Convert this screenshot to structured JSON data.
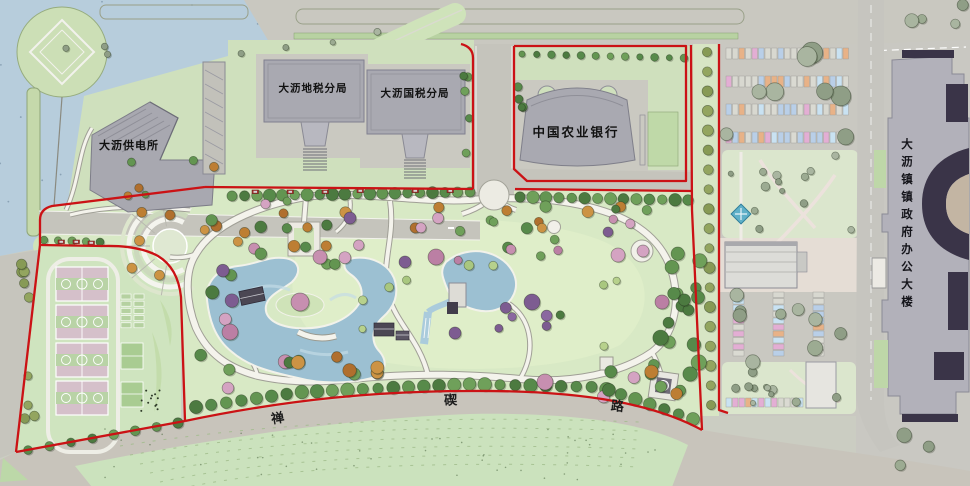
{
  "plan": {
    "title": "大沥镇政府周边公园景观总平面图",
    "buildings": {
      "power_station": "大沥供电所",
      "local_tax": "大沥地税分局",
      "national_tax": "大沥国税分局",
      "bank": "中国农业银行",
      "government": "大沥镇镇政府办公大楼"
    },
    "road": {
      "name": "禅碶路",
      "chars": [
        "禅",
        "碶",
        "路"
      ]
    },
    "colors": {
      "boundary_red": "#cb1215",
      "water": "#b7cddc",
      "lake": "#9cc0d2",
      "lawn": "#cfe0bd",
      "park_green": "#d8e9c5",
      "road_gray": "#c5c4bc",
      "building_gray": "#b2b1ba",
      "building_dark": "#3a3448",
      "court_pink": "#d5c0ca",
      "tree_green": "#578a4a"
    }
  }
}
